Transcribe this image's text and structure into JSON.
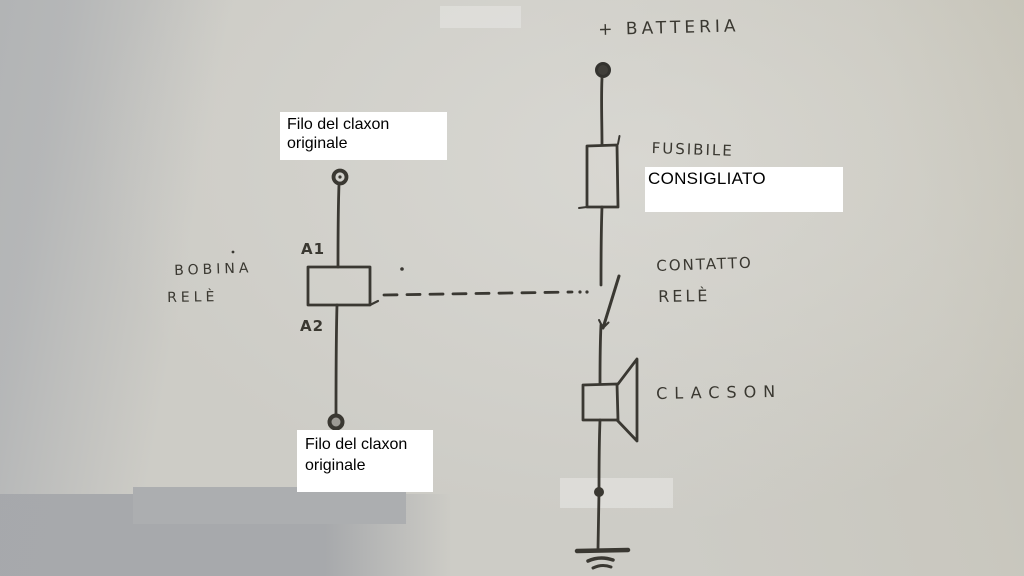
{
  "colors": {
    "ink": "#3a3832",
    "paper": "#cdccc6",
    "note_background": "#ffffff",
    "note_text": "#000000"
  },
  "schematic": {
    "battery_label": "+ BATTERIA",
    "fuse_label": "FUSIBILE",
    "contact_label": {
      "line1": "CONTATTO",
      "line2": "RELÈ"
    },
    "horn_label": "CLACSON",
    "coil_label": {
      "line1": "BOBINA",
      "line2": "RELÈ"
    },
    "coil_terminals": {
      "a1": "A1",
      "a2": "A2"
    }
  },
  "annotations": {
    "wire_note_top": "Filo del claxon originale",
    "wire_note_bottom": "Filo del claxon originale",
    "recommended_note": "CONSIGLIATO"
  }
}
